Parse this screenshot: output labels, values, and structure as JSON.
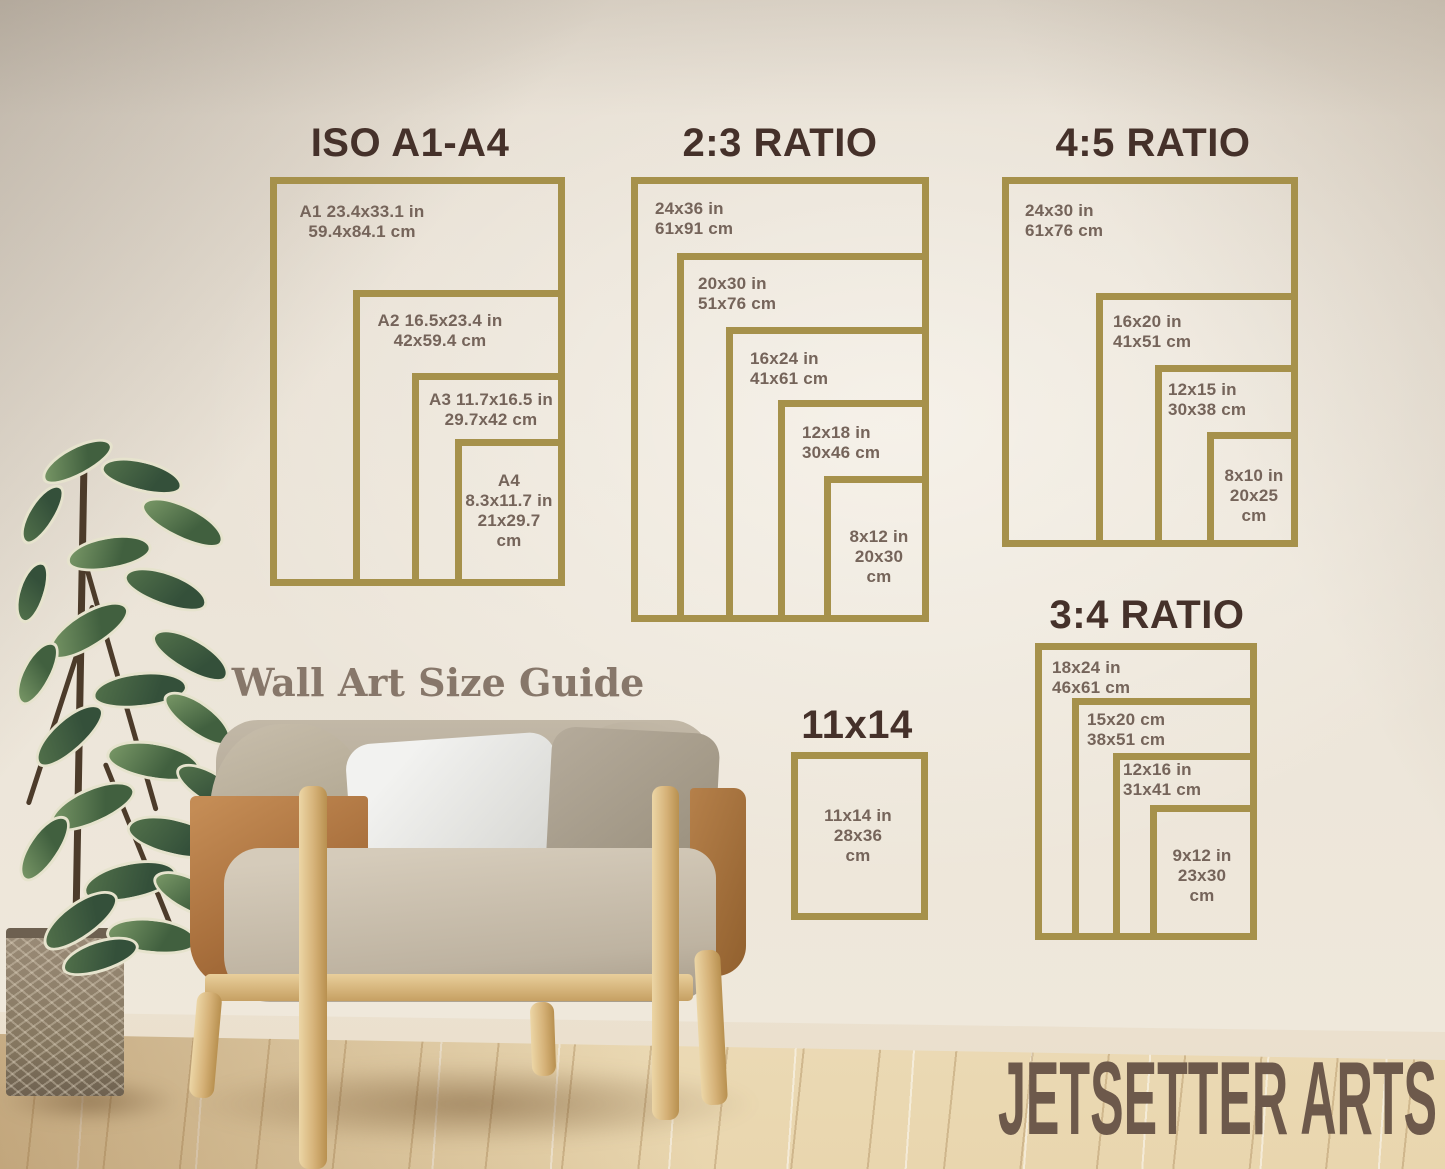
{
  "page": {
    "caption": "Wall Art Size Guide",
    "brand": "JETSETTER ARTS"
  },
  "colors": {
    "frame_gold": "#a6914b",
    "heading_brown": "#45312a",
    "label_brown": "#75645a",
    "caption_brown": "#87776a",
    "brand_brown": "#6d594b",
    "wall_cream": "#ece5d9",
    "floor_wood": "#f2e6cd"
  },
  "sections": {
    "iso": {
      "heading": "ISO A1-A4",
      "frames": {
        "a1": {
          "lines": [
            "A1 23.4x33.1 in",
            "59.4x84.1 cm"
          ]
        },
        "a2": {
          "lines": [
            "A2 16.5x23.4 in",
            "42x59.4 cm"
          ]
        },
        "a3": {
          "lines": [
            "A3 11.7x16.5 in",
            "29.7x42 cm"
          ]
        },
        "a4": {
          "lines": [
            "A4",
            "8.3x11.7 in",
            "21x29.7",
            "cm"
          ]
        }
      }
    },
    "r23": {
      "heading": "2:3 RATIO",
      "frames": {
        "f24x36": {
          "lines": [
            "24x36 in",
            "61x91 cm"
          ]
        },
        "f20x30": {
          "lines": [
            "20x30 in",
            "51x76 cm"
          ]
        },
        "f16x24": {
          "lines": [
            "16x24 in",
            "41x61 cm"
          ]
        },
        "f12x18": {
          "lines": [
            "12x18 in",
            "30x46 cm"
          ]
        },
        "f8x12": {
          "lines": [
            "8x12 in",
            "20x30",
            "cm"
          ]
        }
      }
    },
    "r45": {
      "heading": "4:5 RATIO",
      "frames": {
        "f24x30": {
          "lines": [
            "24x30 in",
            "61x76 cm"
          ]
        },
        "f16x20": {
          "lines": [
            "16x20 in",
            "41x51 cm"
          ]
        },
        "f12x15": {
          "lines": [
            "12x15 in",
            "30x38 cm"
          ]
        },
        "f8x10": {
          "lines": [
            "8x10 in",
            "20x25",
            "cm"
          ]
        }
      }
    },
    "r34": {
      "heading": "3:4 RATIO",
      "frames": {
        "f18x24": {
          "lines": [
            "18x24 in",
            "46x61 cm"
          ]
        },
        "f15x20": {
          "lines": [
            "15x20 cm",
            "38x51 cm"
          ]
        },
        "f12x16": {
          "lines": [
            "12x16 in",
            "31x41 cm"
          ]
        },
        "f9x12": {
          "lines": [
            "9x12 in",
            "23x30",
            "cm"
          ]
        }
      }
    },
    "s1114": {
      "heading": "11x14",
      "frames": {
        "f11x14": {
          "lines": [
            "11x14 in",
            "28x36",
            "cm"
          ]
        }
      }
    }
  }
}
